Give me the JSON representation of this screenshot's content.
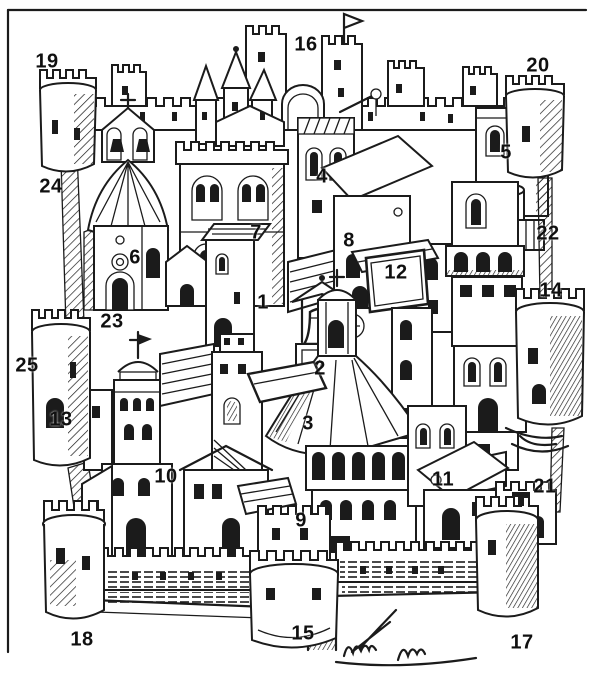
{
  "figure": {
    "background": "#ffffff",
    "ink": "#1b1b1b"
  },
  "labels": [
    {
      "text": "1",
      "x": 263,
      "y": 303
    },
    {
      "text": "2",
      "x": 320,
      "y": 369
    },
    {
      "text": "3",
      "x": 308,
      "y": 424
    },
    {
      "text": "4",
      "x": 322,
      "y": 177
    },
    {
      "text": "5",
      "x": 506,
      "y": 153
    },
    {
      "text": "6",
      "x": 135,
      "y": 258
    },
    {
      "text": "7",
      "x": 256,
      "y": 233
    },
    {
      "text": "8",
      "x": 349,
      "y": 241
    },
    {
      "text": "9",
      "x": 301,
      "y": 521
    },
    {
      "text": "10",
      "x": 166,
      "y": 477
    },
    {
      "text": "11",
      "x": 443,
      "y": 480
    },
    {
      "text": "12",
      "x": 396,
      "y": 273
    },
    {
      "text": "13",
      "x": 61,
      "y": 420
    },
    {
      "text": "14",
      "x": 551,
      "y": 291
    },
    {
      "text": "15",
      "x": 303,
      "y": 634
    },
    {
      "text": "16",
      "x": 306,
      "y": 45
    },
    {
      "text": "17",
      "x": 522,
      "y": 643
    },
    {
      "text": "18",
      "x": 82,
      "y": 640
    },
    {
      "text": "19",
      "x": 47,
      "y": 62
    },
    {
      "text": "20",
      "x": 538,
      "y": 66
    },
    {
      "text": "21",
      "x": 545,
      "y": 487
    },
    {
      "text": "22",
      "x": 548,
      "y": 234
    },
    {
      "text": "23",
      "x": 112,
      "y": 322
    },
    {
      "text": "24",
      "x": 51,
      "y": 187
    },
    {
      "text": "25",
      "x": 27,
      "y": 366
    }
  ]
}
